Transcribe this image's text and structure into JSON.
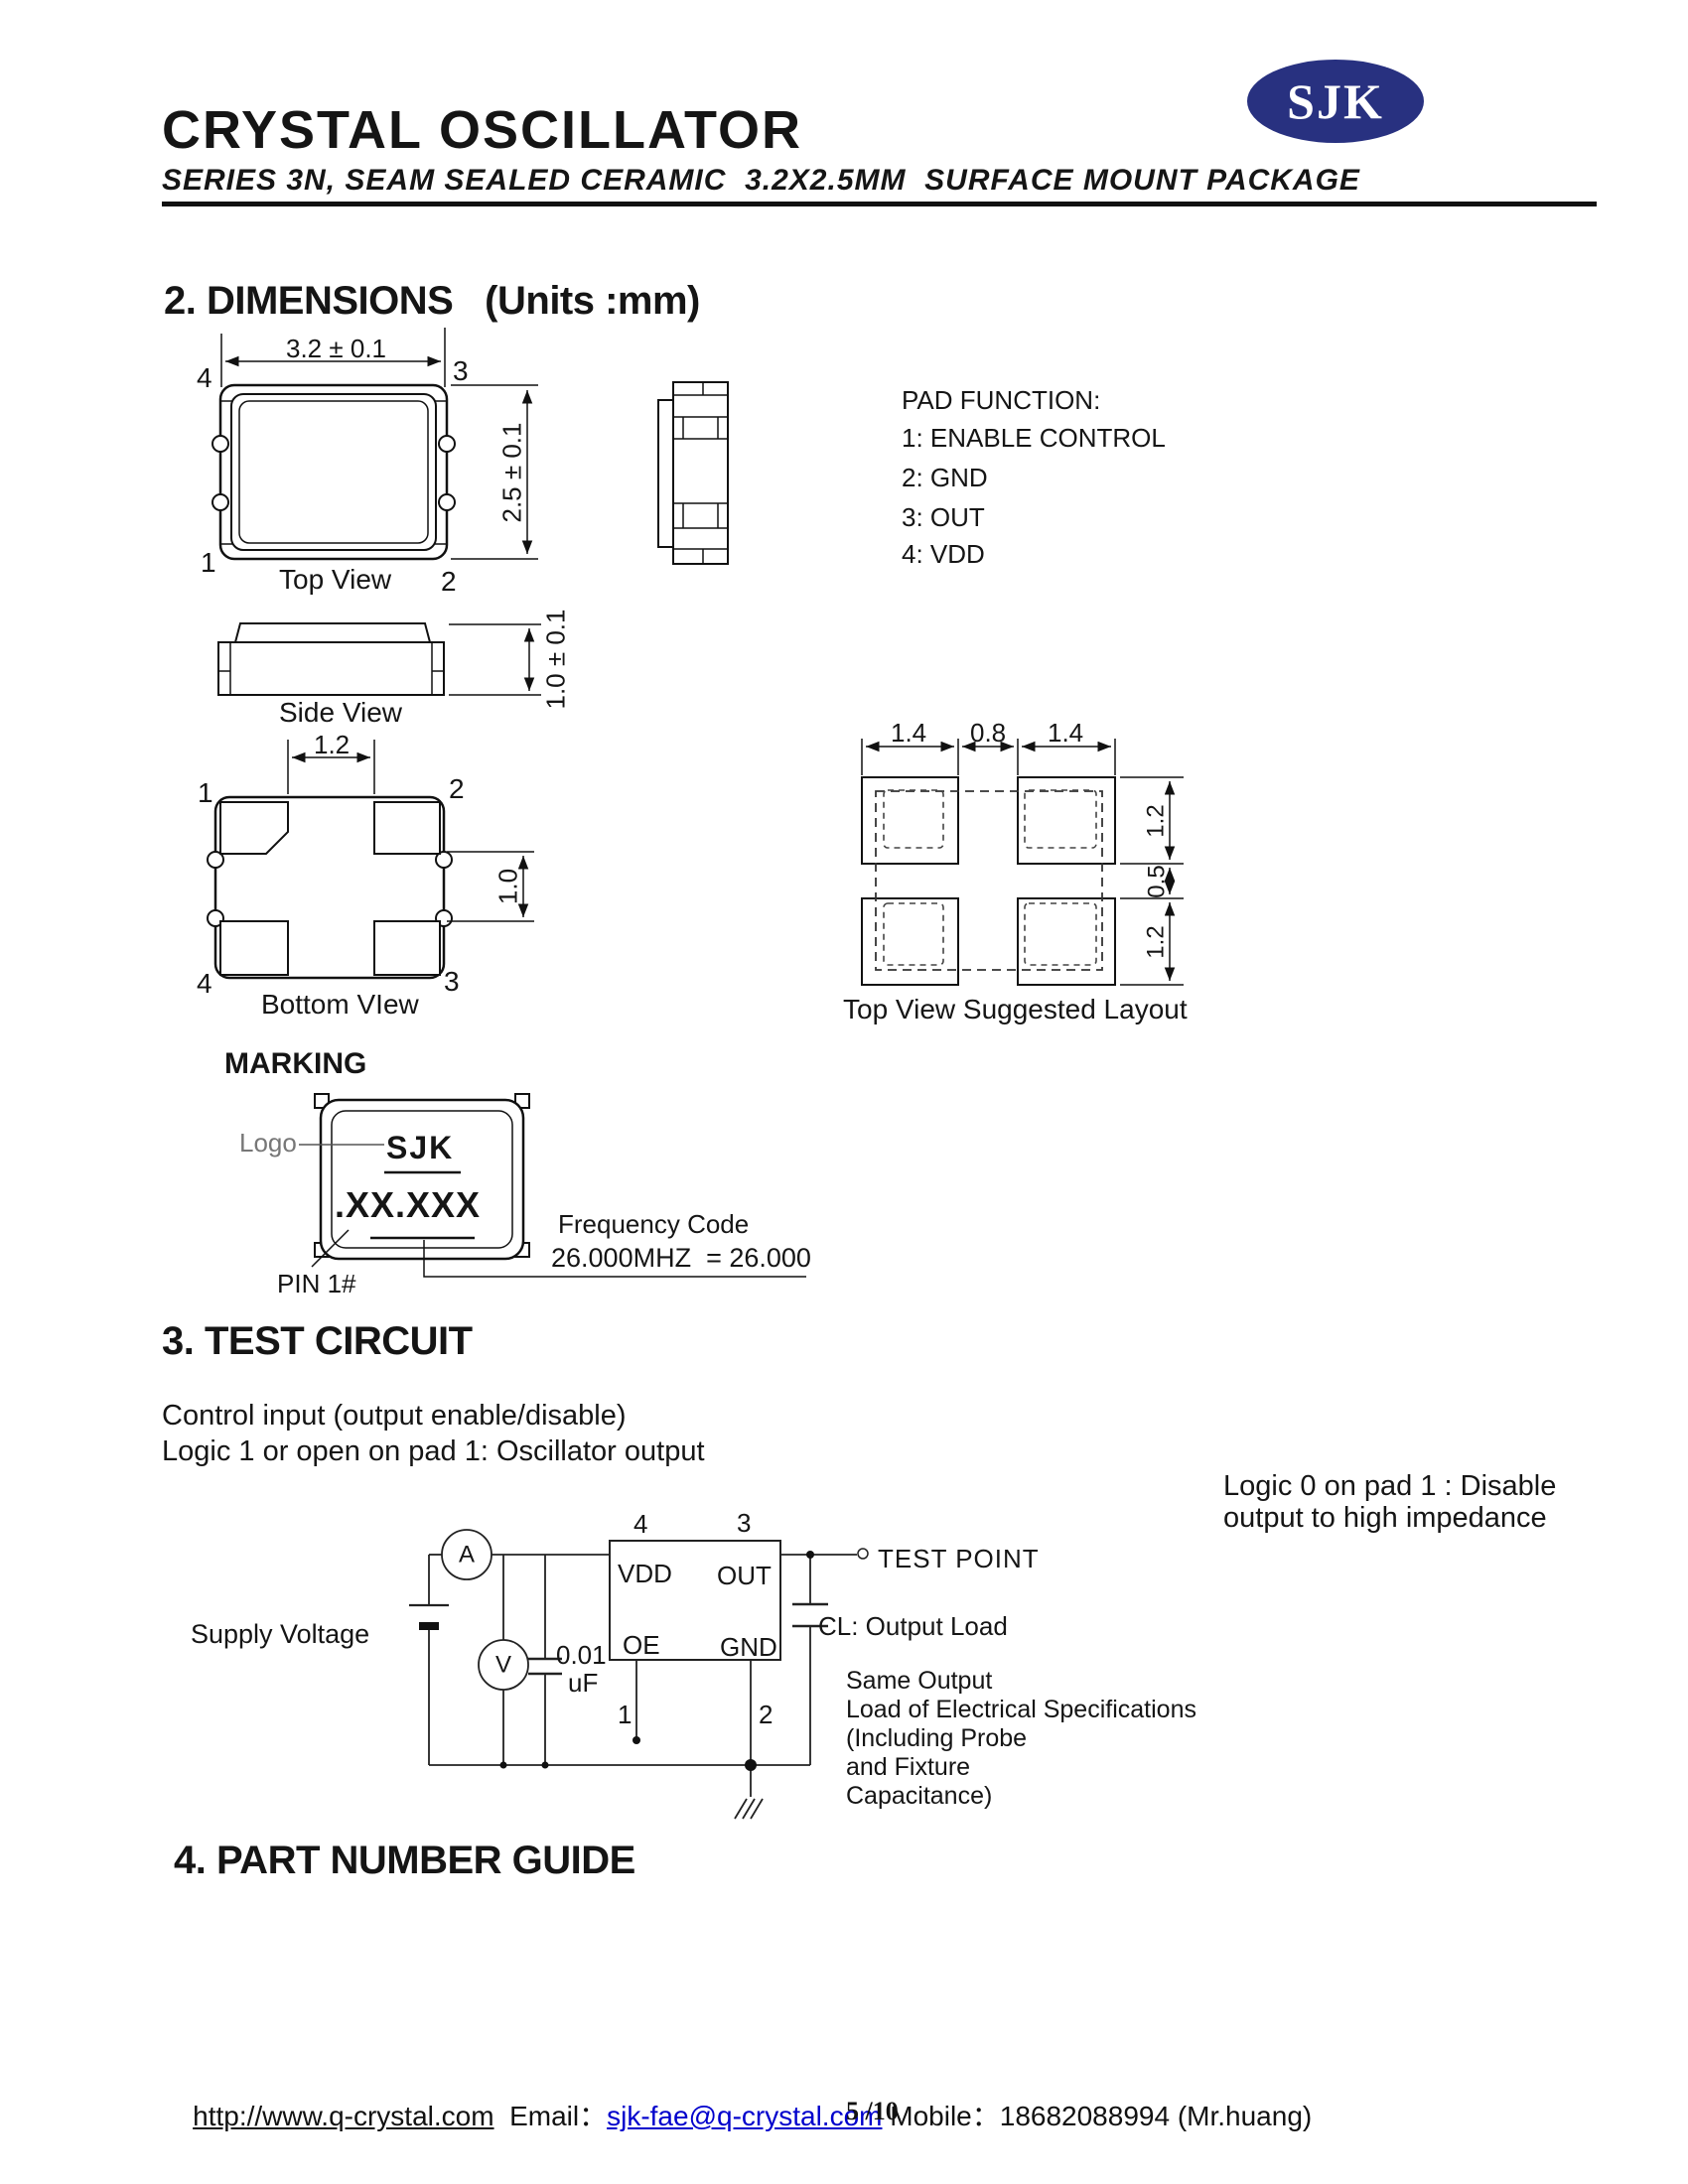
{
  "colors": {
    "logo_navy": "#283180",
    "link_blue": "#0000CC",
    "ink": "#111111"
  },
  "header": {
    "title": "CRYSTAL OSCILLATOR",
    "subtitle": "SERIES 3N, SEAM SEALED CERAMIC  3.2X2.5MM  SURFACE MOUNT PACKAGE",
    "logo_text": "SJK"
  },
  "dimensions": {
    "heading": "2. DIMENSIONS   (Units :mm)",
    "top_view": {
      "width_dim": "3.2 ± 0.1",
      "height_dim": "2.5 ± 0.1",
      "pin_tl": "4",
      "pin_tr": "3",
      "pin_bl": "1",
      "pin_br": "2",
      "caption": "Top View"
    },
    "side_view": {
      "height_dim": "1.0 ± 0.1",
      "caption": "Side View"
    },
    "bottom_view": {
      "top_dim": "1.2",
      "right_dim": "1.0",
      "pin_tl": "1",
      "pin_tr": "2",
      "pin_bl": "4",
      "pin_br": "3",
      "caption": "Bottom VIew"
    },
    "pad_function": {
      "title": "PAD FUNCTION:",
      "items": [
        "1: ENABLE CONTROL",
        "2: GND",
        "3: OUT",
        "4: VDD"
      ]
    },
    "suggested_layout": {
      "dim_left": "1.4",
      "dim_mid": "0.8",
      "dim_right": "1.4",
      "dim_r1": "1.2",
      "dim_r2": "0.5",
      "dim_r3": "1.2",
      "caption": "Top View Suggested Layout"
    },
    "marking": {
      "heading": "MARKING",
      "logo_label": "Logo",
      "logo_text": "SJK",
      "code_text": ".XX.XXX",
      "pin_label": "PIN 1#",
      "freq_title": "Frequency Code",
      "freq_example": "26.000MHZ  = 26.000"
    }
  },
  "test_circuit": {
    "heading": "3. TEST CIRCUIT",
    "note_line1": "Control input (output enable/disable)",
    "note_line2": "Logic 1 or open on pad 1: Oscillator output",
    "right_note_line1": "Logic 0 on pad 1 : Disable",
    "right_note_line2": "output to high impedance",
    "supply_label": "Supply Voltage",
    "ammeter": "A",
    "voltmeter": "V",
    "cap_value": "0.01",
    "cap_unit": "uF",
    "pin4": "4",
    "pin3": "3",
    "pin1": "1",
    "pin2": "2",
    "vdd": "VDD",
    "out": "OUT",
    "oe": "OE",
    "gnd": "GND",
    "test_point": "TEST POINT",
    "cl_label": "CL: Output Load",
    "load_note_lines": [
      "Same Output",
      "Load of Electrical Specifications",
      "(Including Probe",
      "and Fixture",
      "Capacitance)"
    ]
  },
  "part_number": {
    "heading": "4. PART NUMBER GUIDE"
  },
  "footer": {
    "url": "http://www.q-crystal.com",
    "email_label": "  Email：",
    "email": "sjk-fae@q-crystal.com",
    "mobile_label": " Mobile：",
    "mobile_value": "18682088994 (Mr.huang)",
    "page": "5 /10"
  }
}
